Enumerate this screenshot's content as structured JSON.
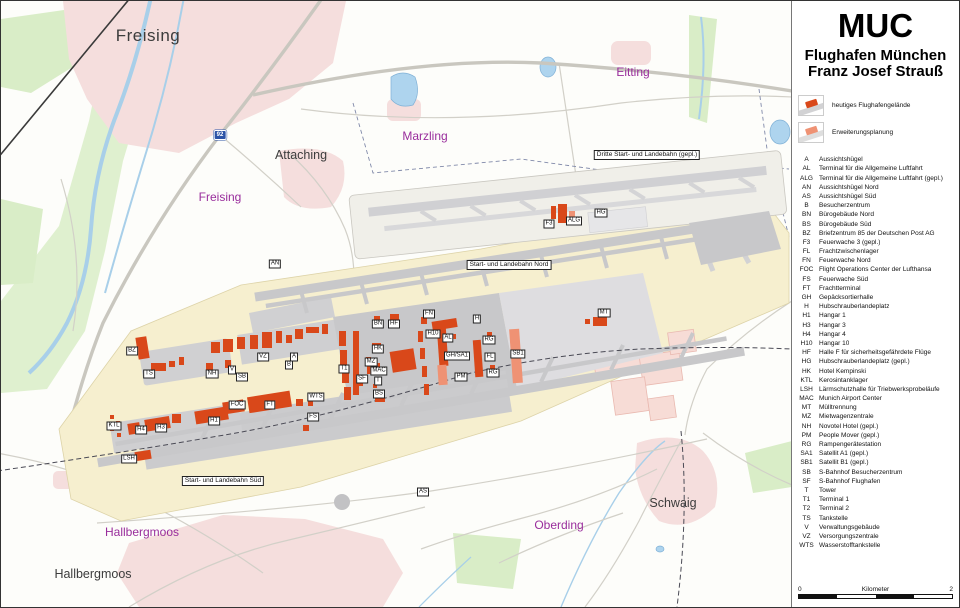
{
  "panel": {
    "title": "MUC",
    "subtitle_line1": "Flughafen München",
    "subtitle_line2": "Franz Josef Strauß",
    "legend": [
      {
        "label": "heutiges Flughafengelände",
        "type": "current"
      },
      {
        "label": "Erweiterungsplanung",
        "type": "planned"
      }
    ],
    "abbreviations": [
      {
        "code": "A",
        "label": "Aussichtshügel"
      },
      {
        "code": "AL",
        "label": "Terminal für die Allgemeine Luftfahrt"
      },
      {
        "code": "ALG",
        "label": "Terminal für die Allgemeine Luftfahrt (gepl.)"
      },
      {
        "code": "AN",
        "label": "Aussichtshügel Nord"
      },
      {
        "code": "AS",
        "label": "Aussichtshügel Süd"
      },
      {
        "code": "B",
        "label": "Besucherzentrum"
      },
      {
        "code": "BN",
        "label": "Bürogebäude Nord"
      },
      {
        "code": "BS",
        "label": "Bürogebäude Süd"
      },
      {
        "code": "BZ",
        "label": "Briefzentrum 85 der Deutschen Post AG"
      },
      {
        "code": "F3",
        "label": "Feuerwache 3 (gepl.)"
      },
      {
        "code": "FL",
        "label": "Frachtzwischenlager"
      },
      {
        "code": "FN",
        "label": "Feuerwache Nord"
      },
      {
        "code": "FOC",
        "label": "Flight Operations Center der Lufthansa"
      },
      {
        "code": "FS",
        "label": "Feuerwache  Süd"
      },
      {
        "code": "FT",
        "label": "Frachtterminal"
      },
      {
        "code": "GH",
        "label": "Gepäcksortierhalle"
      },
      {
        "code": "H",
        "label": "Hubschrauberlandeplatz"
      },
      {
        "code": "H1",
        "label": "Hangar 1"
      },
      {
        "code": "H3",
        "label": "Hangar 3"
      },
      {
        "code": "H4",
        "label": "Hangar 4"
      },
      {
        "code": "H10",
        "label": "Hangar 10"
      },
      {
        "code": "HF",
        "label": "Halle F für sicherheitsgefährdete Flüge"
      },
      {
        "code": "HG",
        "label": "Hubschrauberlandeplatz (gepl.)"
      },
      {
        "code": "HK",
        "label": "Hotel Kempinski"
      },
      {
        "code": "KTL",
        "label": "Kerosintanklager"
      },
      {
        "code": "LSH",
        "label": "Lärmschutzhalle für Triebwerksprobeläufe"
      },
      {
        "code": "MAC",
        "label": "Munich Airport Center"
      },
      {
        "code": "MT",
        "label": "Mülltrennung"
      },
      {
        "code": "MZ",
        "label": "Mietwagenzentrale"
      },
      {
        "code": "NH",
        "label": "Novotel Hotel (gepl.)"
      },
      {
        "code": "PM",
        "label": "People Mover (gepl.)"
      },
      {
        "code": "RG",
        "label": "Rampengerätestation"
      },
      {
        "code": "SA1",
        "label": "Satellit A1 (gepl.)"
      },
      {
        "code": "SB1",
        "label": "Satellit B1 (gepl.)"
      },
      {
        "code": "SB",
        "label": "S-Bahnhof Besucherzentrum"
      },
      {
        "code": "SF",
        "label": "S-Bahnhof Flughafen"
      },
      {
        "code": "T",
        "label": "Tower"
      },
      {
        "code": "T1",
        "label": "Terminal 1"
      },
      {
        "code": "T2",
        "label": "Terminal 2"
      },
      {
        "code": "TS",
        "label": "Tankstelle"
      },
      {
        "code": "V",
        "label": "Verwaltungsgebäude"
      },
      {
        "code": "VZ",
        "label": "Versorgungszentrale"
      },
      {
        "code": "WTS",
        "label": "Wasserstofftankstelle"
      }
    ],
    "scalebar": {
      "left": "0",
      "center": "Kilometer",
      "right": "2"
    }
  },
  "map": {
    "place_labels": [
      {
        "text": "Freising",
        "x": 147,
        "y": 35,
        "style": "city-large"
      },
      {
        "text": "Attaching",
        "x": 300,
        "y": 154,
        "style": "city"
      },
      {
        "text": "Freising",
        "x": 219,
        "y": 196,
        "style": "municipality"
      },
      {
        "text": "Marzling",
        "x": 424,
        "y": 135,
        "style": "municipality"
      },
      {
        "text": "Eitting",
        "x": 632,
        "y": 71,
        "style": "municipality"
      },
      {
        "text": "Hallbergmoos",
        "x": 141,
        "y": 531,
        "style": "municipality"
      },
      {
        "text": "Hallbergmoos",
        "x": 92,
        "y": 573,
        "style": "city"
      },
      {
        "text": "Oberding",
        "x": 558,
        "y": 524,
        "style": "municipality"
      },
      {
        "text": "Schwaig",
        "x": 672,
        "y": 502,
        "style": "city"
      }
    ],
    "runway_labels": [
      {
        "text": "Dritte Start- und Landebahn (gepl.)",
        "x": 646,
        "y": 154
      },
      {
        "text": "Start- und Landebahn Nord",
        "x": 508,
        "y": 264
      },
      {
        "text": "Start- und Landebahn Süd",
        "x": 222,
        "y": 480
      }
    ],
    "road_shield": {
      "text": "92",
      "x": 219,
      "y": 134
    },
    "code_labels": [
      {
        "code": "AN",
        "x": 274,
        "y": 263
      },
      {
        "code": "BZ",
        "x": 131,
        "y": 350
      },
      {
        "code": "TS",
        "x": 148,
        "y": 373
      },
      {
        "code": "NH",
        "x": 211,
        "y": 373
      },
      {
        "code": "V",
        "x": 231,
        "y": 369
      },
      {
        "code": "SB",
        "x": 241,
        "y": 376
      },
      {
        "code": "VZ",
        "x": 262,
        "y": 356
      },
      {
        "code": "B",
        "x": 288,
        "y": 364
      },
      {
        "code": "A",
        "x": 293,
        "y": 356
      },
      {
        "code": "FOC",
        "x": 236,
        "y": 404
      },
      {
        "code": "FT",
        "x": 269,
        "y": 404
      },
      {
        "code": "WTS",
        "x": 315,
        "y": 396
      },
      {
        "code": "FS",
        "x": 312,
        "y": 416
      },
      {
        "code": "KTL",
        "x": 113,
        "y": 425
      },
      {
        "code": "H4",
        "x": 140,
        "y": 429
      },
      {
        "code": "H3",
        "x": 160,
        "y": 427
      },
      {
        "code": "H1",
        "x": 213,
        "y": 420
      },
      {
        "code": "LSH",
        "x": 128,
        "y": 458
      },
      {
        "code": "T1",
        "x": 343,
        "y": 368
      },
      {
        "code": "SF",
        "x": 361,
        "y": 378
      },
      {
        "code": "T",
        "x": 377,
        "y": 380
      },
      {
        "code": "BS",
        "x": 378,
        "y": 393
      },
      {
        "code": "MAC",
        "x": 378,
        "y": 370
      },
      {
        "code": "MZ",
        "x": 370,
        "y": 361
      },
      {
        "code": "HK",
        "x": 377,
        "y": 348
      },
      {
        "code": "BN",
        "x": 377,
        "y": 323
      },
      {
        "code": "HF",
        "x": 393,
        "y": 323
      },
      {
        "code": "FN",
        "x": 428,
        "y": 313
      },
      {
        "code": "H10",
        "x": 432,
        "y": 333
      },
      {
        "code": "AL",
        "x": 447,
        "y": 337
      },
      {
        "code": "H",
        "x": 476,
        "y": 318
      },
      {
        "code": "RG",
        "x": 488,
        "y": 339
      },
      {
        "code": "FL",
        "x": 489,
        "y": 356
      },
      {
        "code": "RG",
        "x": 492,
        "y": 372
      },
      {
        "code": "GH/SA1",
        "x": 456,
        "y": 355
      },
      {
        "code": "PM",
        "x": 460,
        "y": 376
      },
      {
        "code": "SB1",
        "x": 517,
        "y": 353
      },
      {
        "code": "MT",
        "x": 603,
        "y": 312
      },
      {
        "code": "F3",
        "x": 548,
        "y": 223
      },
      {
        "code": "ALG",
        "x": 573,
        "y": 220
      },
      {
        "code": "HG",
        "x": 600,
        "y": 212
      },
      {
        "code": "AS",
        "x": 422,
        "y": 491
      }
    ]
  },
  "colors": {
    "grounds_current": "#f6efcf",
    "expansion": "#f0efe9",
    "apron": "#c8c8ca",
    "apron_planned": "#dedde0",
    "building": "#d9481a",
    "building_planned": "#ef9274",
    "urban": "#f5dedd",
    "green": "#d9edc7",
    "water": "#a8cfe9",
    "road": "#d2d0c8",
    "label_purple": "#992d9c",
    "shield_blue": "#2b53a7"
  }
}
